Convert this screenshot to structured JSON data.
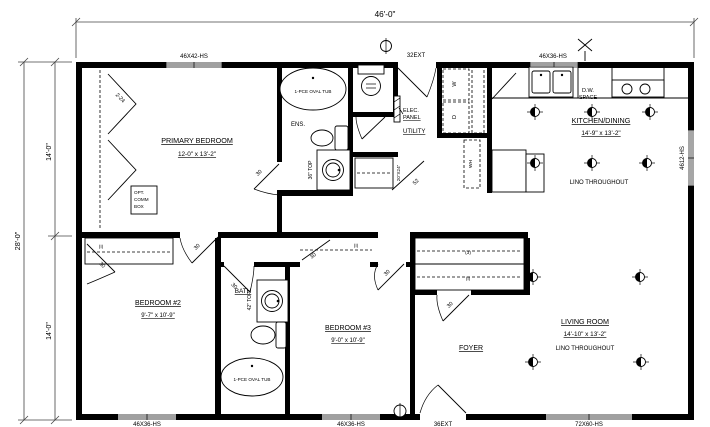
{
  "dimensions": {
    "overall_width": "46'-0\"",
    "overall_depth": "28'-0\"",
    "upper_depth": "14'-0\"",
    "lower_depth": "14'-0\""
  },
  "rooms": {
    "primary_bedroom": {
      "name": "PRIMARY BEDROOM",
      "size": "12-0\" x 13'-2\""
    },
    "ensuite": {
      "name": "ENS."
    },
    "bath": {
      "name": "BATH"
    },
    "utility": {
      "name": "UTILITY"
    },
    "foyer": {
      "name": "FOYER"
    },
    "kitchen_dining": {
      "name": "KITCHEN/DINING",
      "size": "14'-9\" x 13'-2\"",
      "floor": "LINO THROUGHOUT"
    },
    "living_room": {
      "name": "LIVING ROOM",
      "size": "14'-10\" x 13'-2\"",
      "floor": "LINO THROUGHOUT"
    },
    "bedroom_2": {
      "name": "BEDROOM #2",
      "size": "9'-7\" x 10'-9\""
    },
    "bedroom_3": {
      "name": "BEDROOM #3",
      "size": "9'-0\" x 10'-9\""
    }
  },
  "windows": {
    "top_left": "46X42-HS",
    "top_right": "46X36-HS",
    "right_side": "4612-HS",
    "bottom_left": "46X36-HS",
    "bottom_center": "46X36-HS",
    "bottom_right": "72X60-HS"
  },
  "doors": {
    "rear_exterior": "32EXT",
    "front_exterior": "36EXT",
    "interior": "30",
    "primary_closet_bifold": "2-24",
    "utility_angled": "52"
  },
  "fixtures": {
    "oval_tub": "1-PCE OVAL TUB",
    "ens_vanity": "36\" TOP",
    "bath_vanity": "42\" TOP",
    "dw_line1": "D.W.",
    "dw_line2": "SPACE",
    "washer": "W",
    "dryer": "D",
    "water_heater": "WH",
    "attic_access": "20\"X24\"",
    "elec_panel_line1": "ELEC.",
    "elec_panel_line2": "PANEL"
  },
  "annotations": {
    "opt_comm_line1": "OPT.",
    "opt_comm_line2": "COMM",
    "opt_comm_line3": "BOX",
    "closet_single": "(I)",
    "closet_triple": "(3)"
  },
  "colors": {
    "line": "#000000",
    "background": "#ffffff"
  }
}
